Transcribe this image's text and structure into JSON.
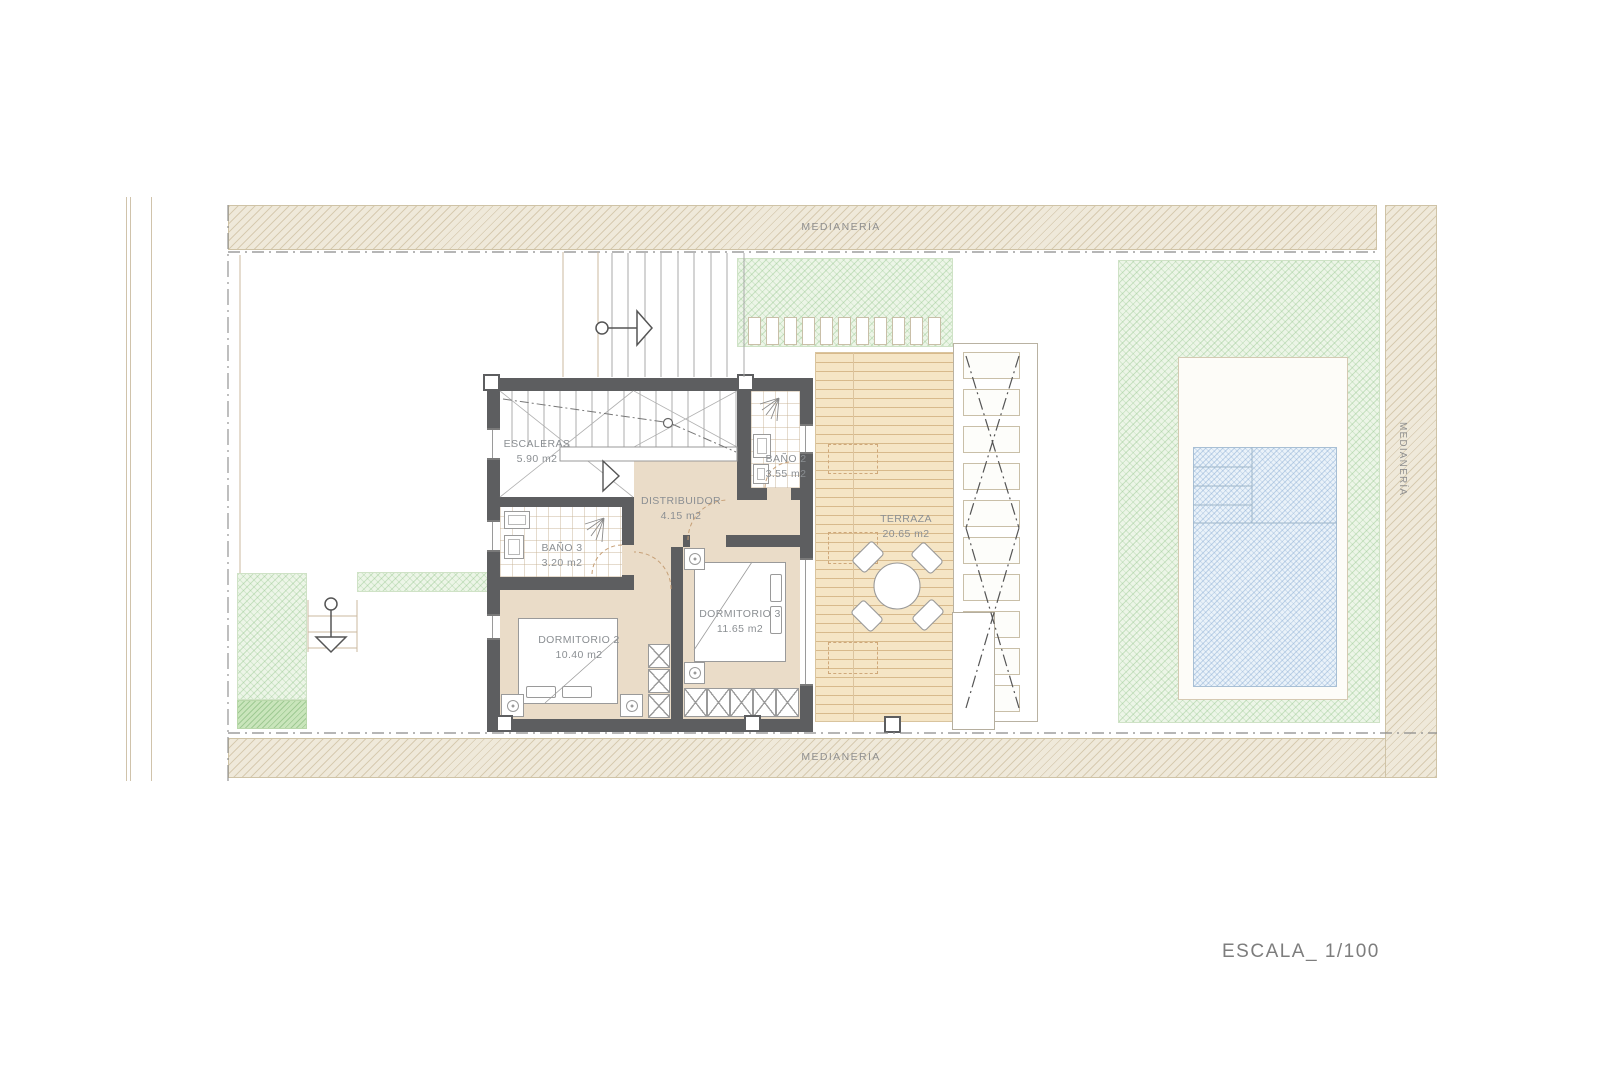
{
  "drawing": {
    "scale_label": "ESCALA_ 1/100",
    "boundary_top": "MEDIANERÍA",
    "boundary_bottom": "MEDIANERÍA",
    "boundary_right": "MEDIANERÍA"
  },
  "rooms": [
    {
      "id": "escaleras",
      "name": "ESCALERAS",
      "area": "5.90 m2"
    },
    {
      "id": "bano2",
      "name": "BAÑO 2",
      "area": "3.55 m2"
    },
    {
      "id": "distribuidor",
      "name": "DISTRIBUIDOR",
      "area": "4.15 m2"
    },
    {
      "id": "bano3",
      "name": "BAÑO 3",
      "area": "3.20 m2"
    },
    {
      "id": "dormitorio2",
      "name": "DORMITORIO 2",
      "area": "10.40 m2"
    },
    {
      "id": "dormitorio3",
      "name": "DORMITORIO 3",
      "area": "11.65 m2"
    },
    {
      "id": "terraza",
      "name": "TERRAZA",
      "area": "20.65 m2"
    }
  ],
  "colors": {
    "wall": "#5d5e60",
    "interior_floor": "#eadcc8",
    "deck": "#f5e5c5",
    "party_wall_hatch": "#efe9da",
    "garden_green": "#ecf5e7",
    "pool_blue": "#eaf2f9",
    "label_gray": "#8b8f93"
  }
}
